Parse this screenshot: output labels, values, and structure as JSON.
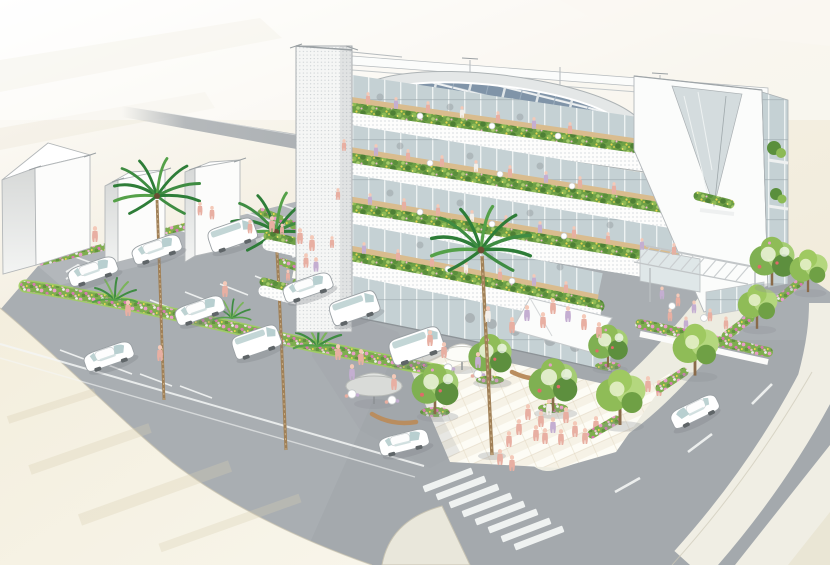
{
  "image": {
    "type": "architectural perspective rendering (hand-tinted style)",
    "subject": "five-story terraced eco building with planted balconies and rooftop solar panels",
    "setting": "street-corner site with plaza, surface parking lot, palm trees, flower beds and roads",
    "text_content": "none"
  },
  "palette": {
    "bg_top": "#ffffff",
    "bg_cream": "#f1ebdb",
    "asphalt": "#a9aeb2",
    "asphalt_dark": "#969da2",
    "sidewalk_beige": "#f0ead8",
    "walkway": "#edece1",
    "plaza_light": "#f6f2e6",
    "plaza_white": "#fdfcf5",
    "plaza_seam": "#ddd2ba",
    "building_white": "#fbfcfb",
    "outline_gray": "#aab0b3",
    "fascia_bg": "#fdfdfc",
    "fascia_dot": "#c6ccd0",
    "glass": "#c5d1d4",
    "glass_mullion": "#edf2f2",
    "deck_wood": "#d9bc8e",
    "foliage": "#6d9f46",
    "foliage_dark": "#4e8035",
    "foliage_light": "#8cba55",
    "flower_pink": "#e79cc7",
    "flower_deep_pink": "#d679b0",
    "flower_yellow": "#e9d64f",
    "flower_white": "#f0eef0",
    "palm_green": "#2e7d38",
    "palm_trunk": "#a08057",
    "tree_green": "#7fb052",
    "street_tree_green": "#8fbc57",
    "car_white": "#ffffff",
    "car_window": "#b8cfd0",
    "wheel_gray": "#5f6568",
    "skin": "#f4c9b8",
    "people_pink": "#e8afa2",
    "people_lavender": "#c4aed1",
    "solar_panel": "#8094a8",
    "marking_white": "#f4f6f5",
    "curb": "#c6c1ae",
    "bench_wood": "#b98d5f",
    "shadow": "#8d9398",
    "bg_road": "#a9aeb2"
  },
  "scene": {
    "building": {
      "floors_visible": 5,
      "features": [
        "rooftop solar panel array ringed by planting",
        "curved white perforated balcony fascias",
        "flower planters with yellow and pink blooms on every floor edge",
        "wood deck terraces with cafe tables and many people",
        "white elevator/stair tower with perforated screen",
        "large white side wall with V-shaped glazed notch and planted balcony",
        "ground-floor glass storefront with folded white entrance canopy",
        "pergola-covered terrace with outdoor dining"
      ]
    },
    "site": {
      "left_background_buildings": 3,
      "parked_vehicles": 9,
      "moving_vehicles": 2,
      "tall_palm_trees": 3,
      "fan_palm_clusters": 3,
      "plaza_trees_with_flower_rings": 4,
      "street_trees": 4,
      "parasols": 2,
      "curved_benches": 2,
      "crosswalks": 2,
      "people_approximate": 75,
      "plaza_paving": "diagonal cream-and-white striped bands",
      "flower_beds": "pink/green borders along parking rows and street edge"
    }
  }
}
